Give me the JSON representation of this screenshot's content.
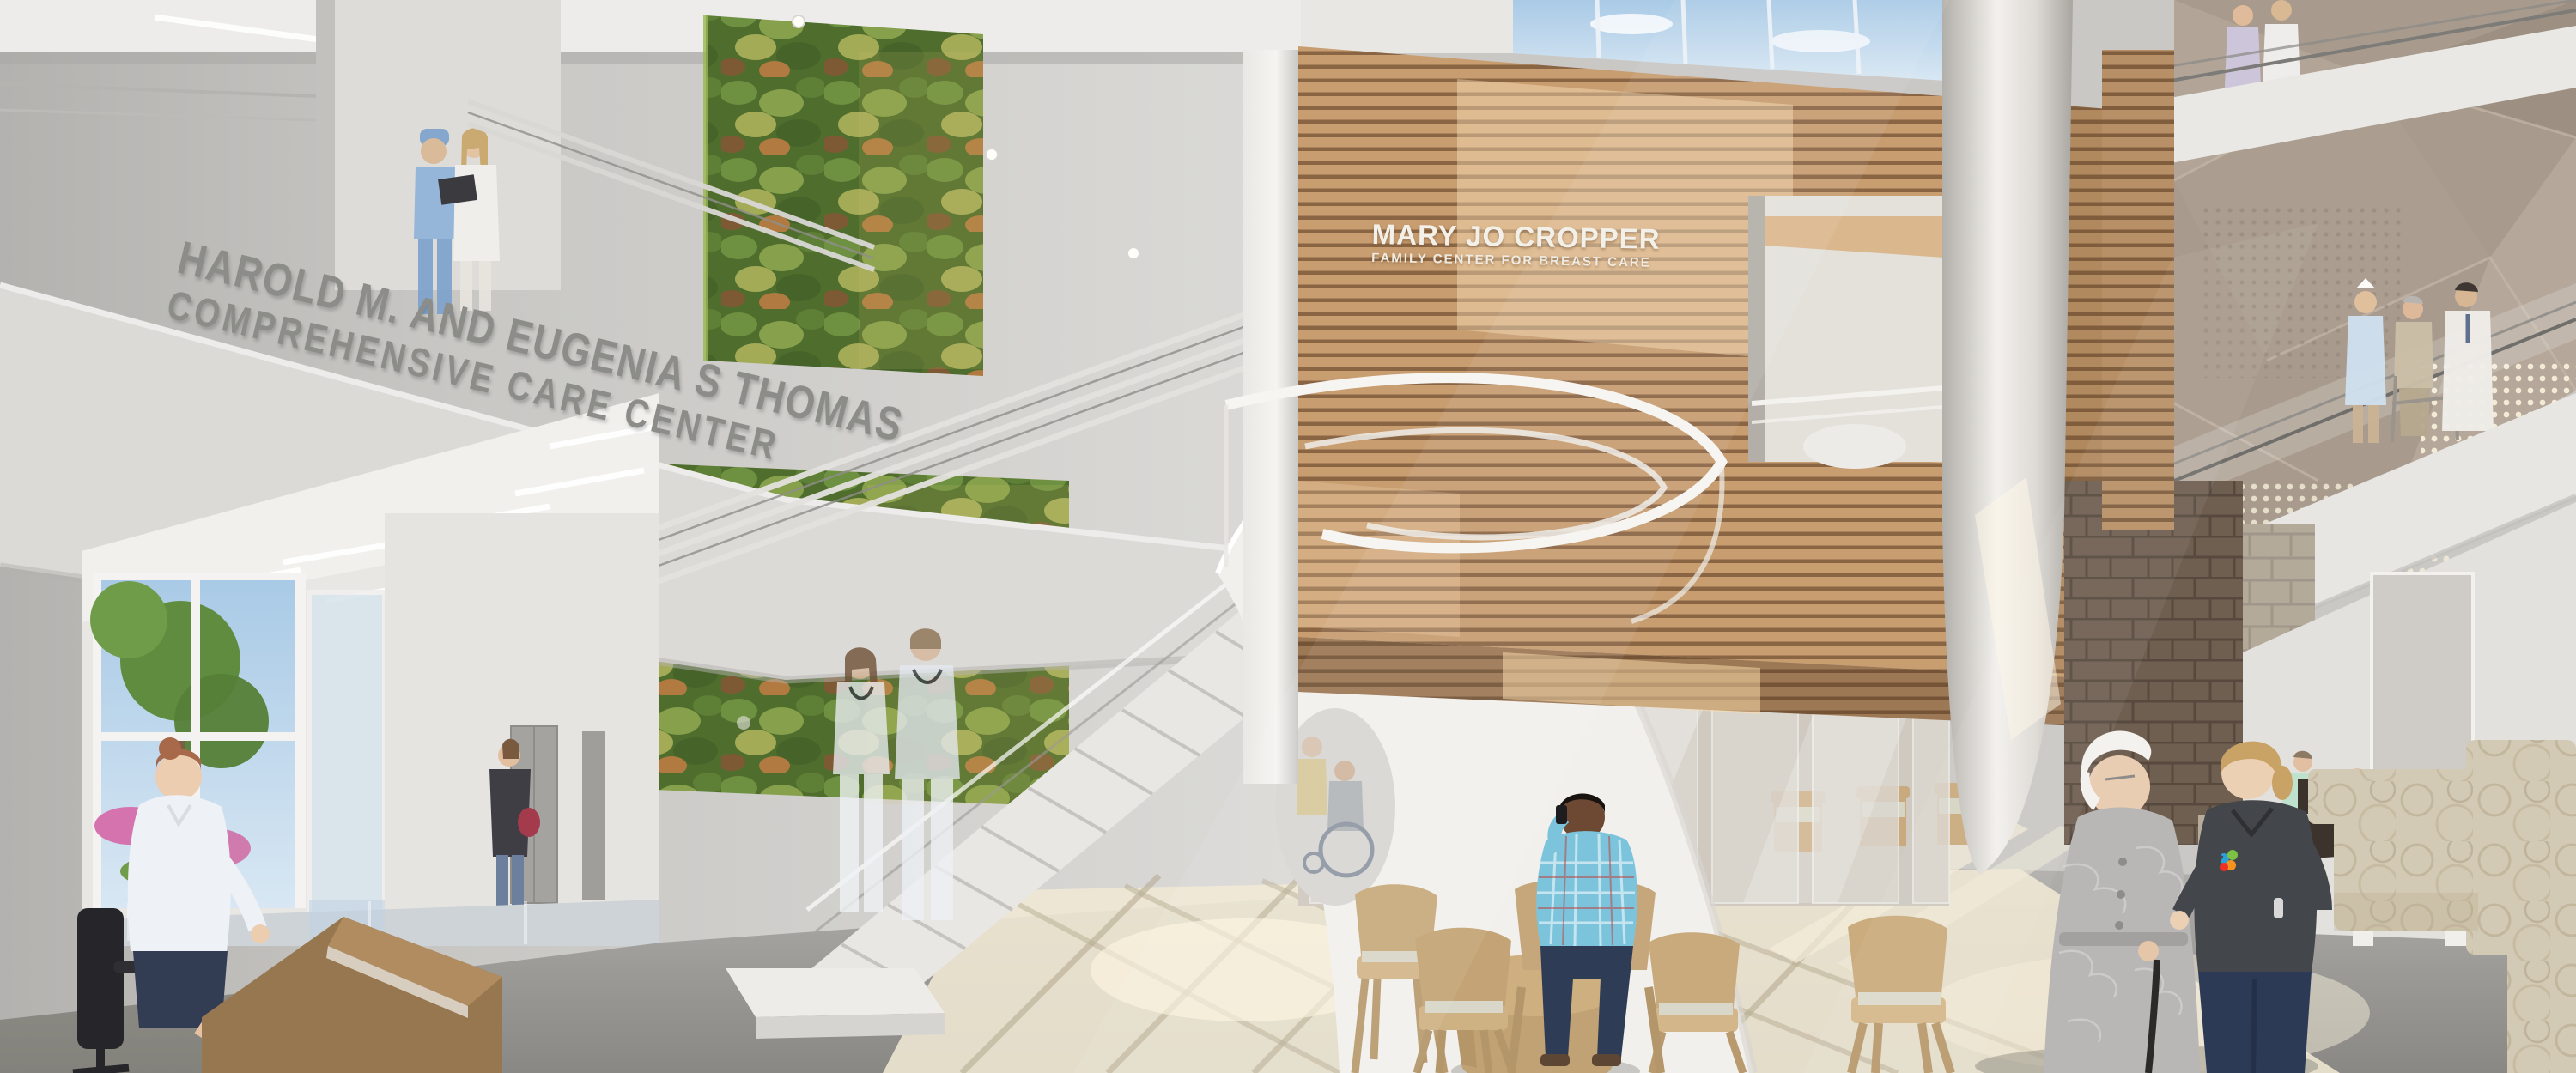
{
  "signage": {
    "care_center": {
      "line1": "HAROLD M. AND EUGENIA S THOMAS",
      "line2": "COMPREHENSIVE CARE CENTER",
      "text_color": "#8c8c88"
    },
    "breast_center": {
      "line1": "MARY JO CROPPER",
      "line2": "FAMILY CENTER FOR BREAST CARE",
      "text_color": "#f3f0ea"
    }
  },
  "palette": {
    "wall": "#d6d5d2",
    "wood_slat": "#c89d70",
    "wood_groove": "#8a6543",
    "green_wall": "#5c7d33",
    "floor": "#a09e9a",
    "sun_pool": "#f0e8d4",
    "faceted_panel": "#a89b8d",
    "sky_glass": "#b9d4ea",
    "stone_dark": "#6f5f51",
    "stone_light": "#b4aa9a",
    "sofa_beige": "#d3cab5",
    "scrubs_dark": "#43464b",
    "scrubs_blue": "#8fb3d8",
    "plaid_shirt": "#7cc4dc",
    "jeans": "#2f3c55",
    "logo_flower": [
      "#2a9fd8",
      "#7dc242",
      "#f7941e",
      "#ee3124"
    ]
  },
  "figures": [
    {
      "id": "surgeon-and-doctor-upper-walkway"
    },
    {
      "id": "ghost-nurse-couple-on-stairs"
    },
    {
      "id": "wheelchair-patient-group"
    },
    {
      "id": "woman-portrait-at-partition"
    },
    {
      "id": "man-behind-partition"
    },
    {
      "id": "man-on-phone-seated"
    },
    {
      "id": "receptionist-at-desk"
    },
    {
      "id": "woman-at-elevators"
    },
    {
      "id": "elderly-woman-with-cane"
    },
    {
      "id": "nurse-escort"
    },
    {
      "id": "balcony-trio-nurse-patient-doctor"
    },
    {
      "id": "balcony-pair-nurse-doctor-top"
    },
    {
      "id": "seated-woman-mint-cardigan"
    },
    {
      "id": "seated-woman-pink-top"
    }
  ]
}
